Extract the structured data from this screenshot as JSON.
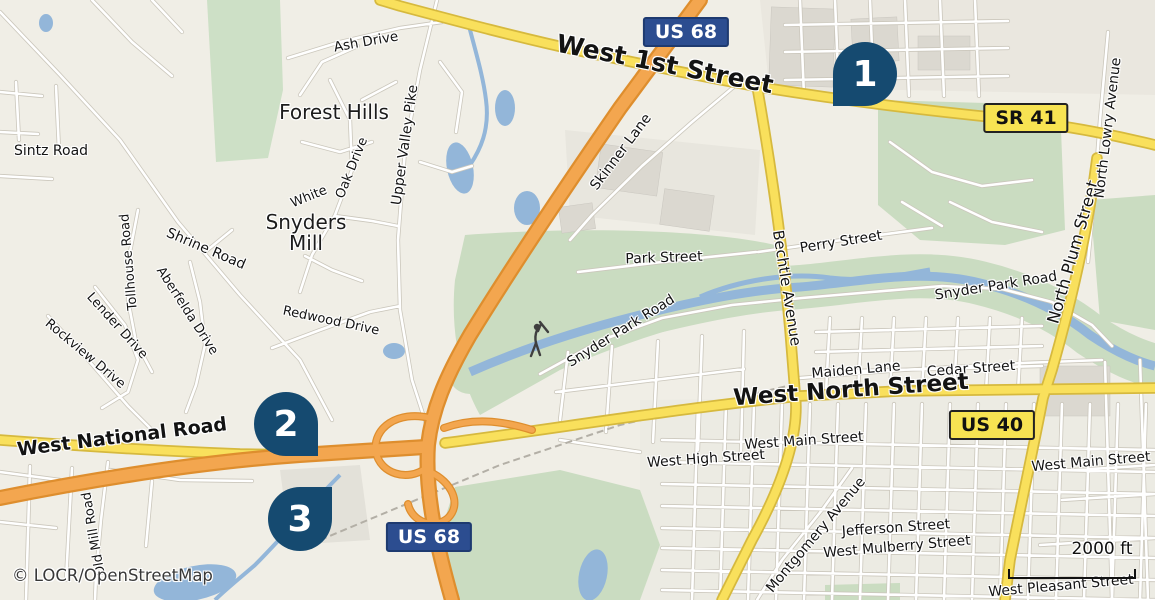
{
  "map": {
    "attribution": "© LOCR/OpenStreetMap",
    "scale_bar": {
      "label": "2000 ft"
    },
    "badges": {
      "us68": "US 68",
      "sr41": "SR 41",
      "us40": "US 40"
    },
    "markers": [
      {
        "label": "1"
      },
      {
        "label": "2"
      },
      {
        "label": "3"
      }
    ],
    "places": {
      "forest_hills": "Forest Hills",
      "snyders_mill": "Snyders Mill"
    },
    "streets": {
      "ash_drive": "Ash Drive",
      "sintz_road": "Sintz Road",
      "white": "White",
      "oak_drive": "Oak Drive",
      "upper_valley_pike": "Upper Valley Pike",
      "shrine_road": "Shrine Road",
      "tollhouse_road": "Tollhouse Road",
      "aberfelda_drive": "Aberfelda Drive",
      "lender_drive": "Lender Drive",
      "rockview_drive": "Rockview Drive",
      "redwood_drive": "Redwood Drive",
      "west_national_road": "West National Road",
      "old_mill_road": "Old Mill Road",
      "west_1st_street": "West 1st Street",
      "skinner_lane": "Skinner Lane",
      "bechtle_avenue": "Bechtle Avenue",
      "perry_street": "Perry Street",
      "park_street": "Park Street",
      "snyder_park_road": "Snyder Park Road",
      "north_plum_street": "North Plum Street",
      "north_lowry_avenue": "North Lowry Avenue",
      "maiden_lane": "Maiden Lane",
      "cedar_street": "Cedar Street",
      "west_north_street": "West North Street",
      "west_main_street": "West Main Street",
      "west_high_street": "West High Street",
      "montgomery_avenue": "Montgomery Avenue",
      "jefferson_street": "Jefferson Street",
      "west_mulberry_street": "West Mulberry Street",
      "west_pleasant_street": "West Pleasant Street"
    },
    "icons": {
      "golfer": "golfer-swing"
    },
    "colors": {
      "motorway": "#f3a64f",
      "primary_road": "#f9e05c",
      "water": "#93b6d9",
      "park": "#cadcc1",
      "marker": "#154a70",
      "badge_blue": "#2c4d90",
      "badge_yellow": "#f7e352"
    }
  }
}
